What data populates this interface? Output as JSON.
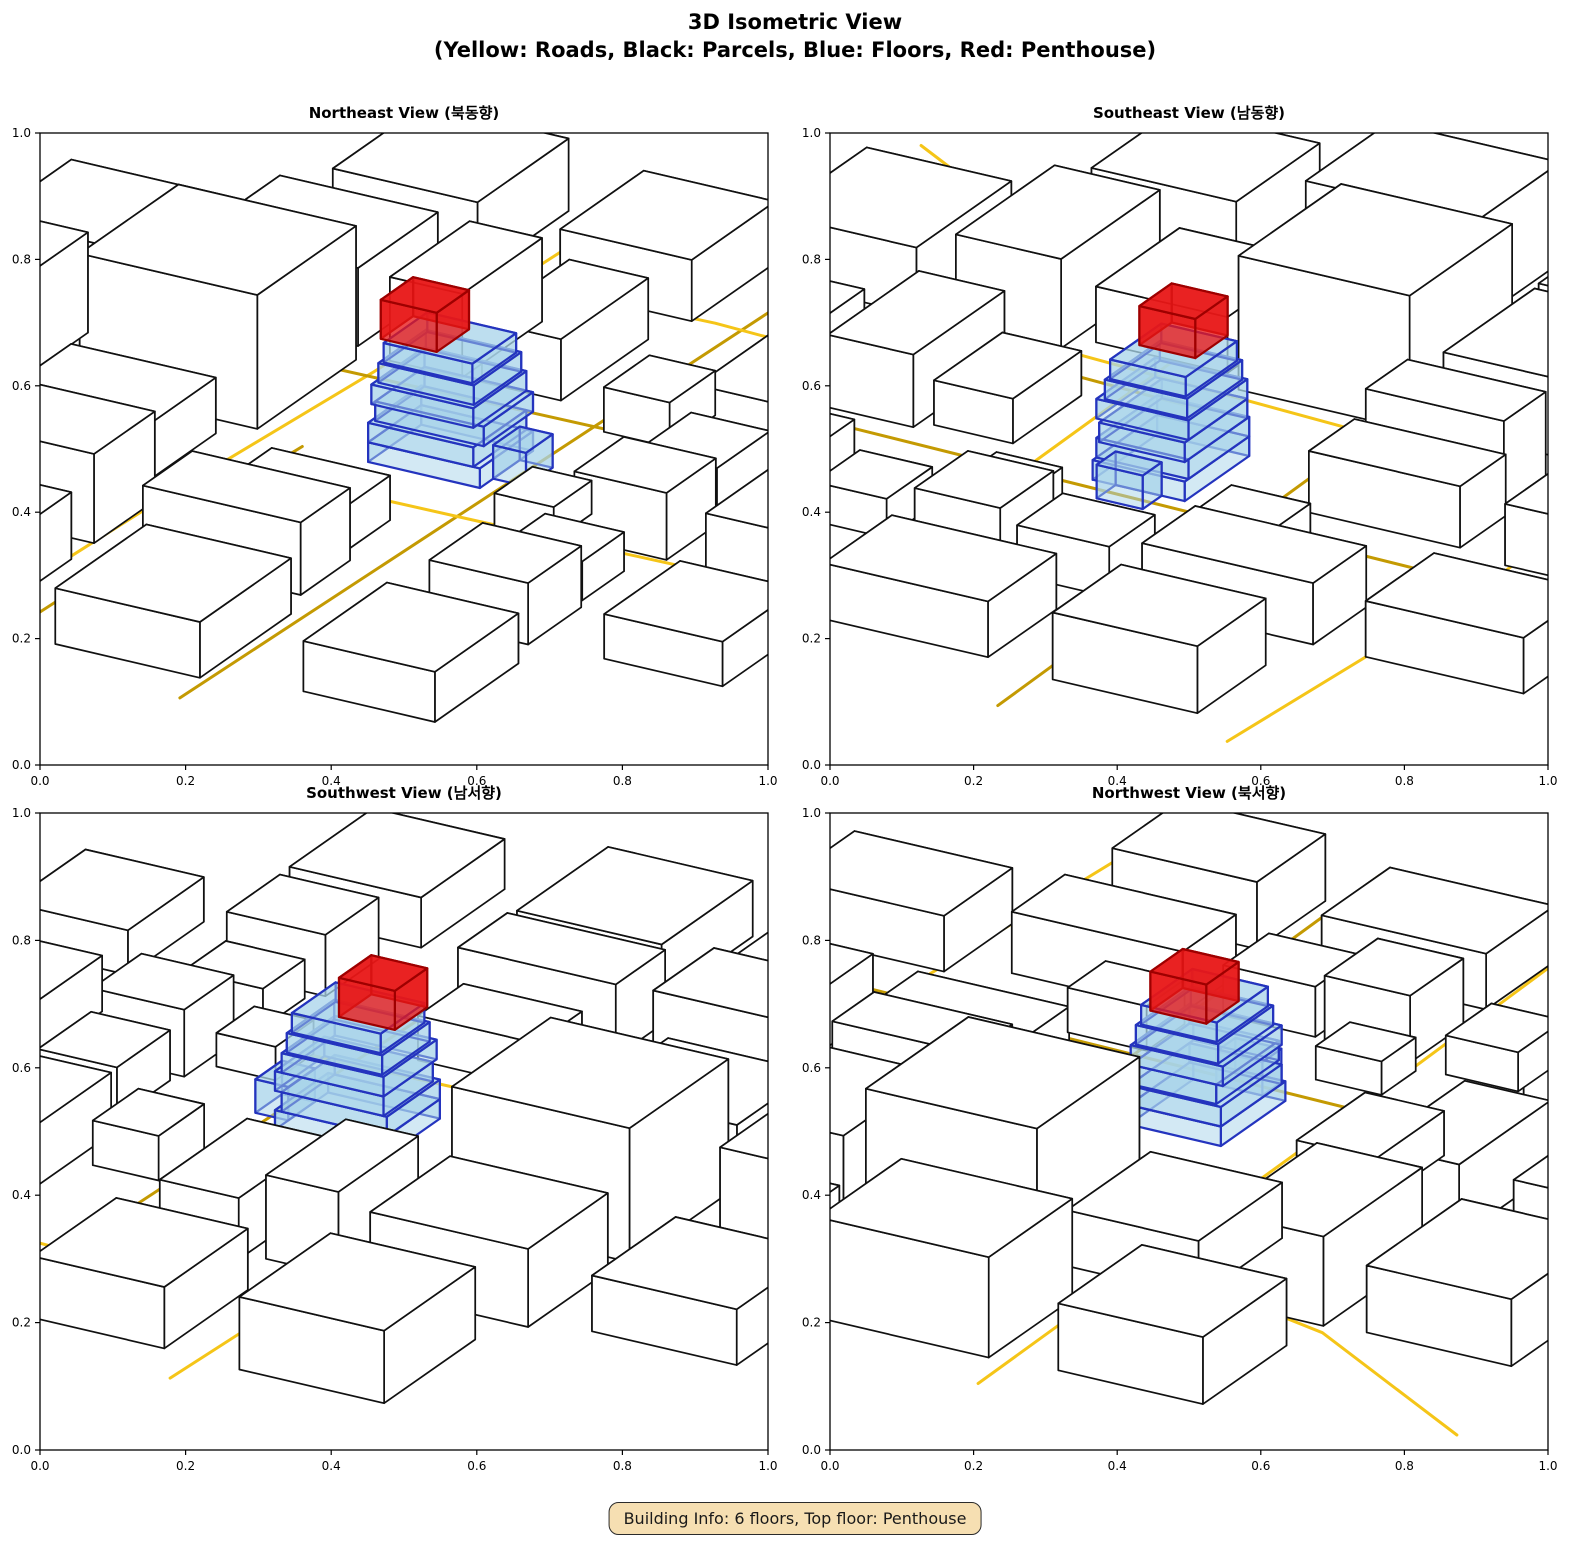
{
  "figure": {
    "title_line1": "3D Isometric View",
    "title_line2": "(Yellow: Roads, Black: Parcels, Blue: Floors, Red: Penthouse)"
  },
  "badge": {
    "text": "Building Info: 6 floors, Top floor: Penthouse"
  },
  "axes": {
    "tick_labels": [
      "0.0",
      "0.2",
      "0.4",
      "0.6",
      "0.8",
      "1.0"
    ],
    "tick_values": [
      0,
      0.2,
      0.4,
      0.6,
      0.8,
      1.0
    ],
    "x_range": [
      0,
      1
    ],
    "y_range": [
      0,
      1
    ]
  },
  "subplots": [
    {
      "id": "ne",
      "title": "Northeast View (북동향)",
      "azimuth_deg": 0
    },
    {
      "id": "se",
      "title": "Southeast View (남동향)",
      "azimuth_deg": -90
    },
    {
      "id": "sw",
      "title": "Southwest View (남서향)",
      "azimuth_deg": 180
    },
    {
      "id": "nw",
      "title": "Northwest View (북서향)",
      "azimuth_deg": 90
    }
  ],
  "colors": {
    "road_gold": "#F5C518",
    "road_dark": "#C49A02",
    "parcel_fill": "#FFFFFF",
    "parcel_edge": "#111111",
    "floor_fill": "#A8D4EA",
    "floor_edge": "#2434BE",
    "floor_opacity": 0.5,
    "penthouse_fill": "#E81717",
    "penthouse_edge": "#9E0000",
    "penthouse_opacity": 0.78,
    "axis": "#000000",
    "badge_bg": "#F6DFB2",
    "badge_border": "#2b2b2b"
  },
  "chart_data": {
    "type": "3d-city-isometric",
    "legend": {
      "roads": "Yellow",
      "parcels": "Black",
      "floors": "Blue",
      "penthouse": "Red"
    },
    "building": {
      "floors": 6,
      "top_floor": "Penthouse",
      "floor_boxes": [
        [
          0.44,
          0.35,
          0.14,
          0.17,
          0.0,
          0.035
        ],
        [
          0.44,
          0.36,
          0.14,
          0.16,
          0.035,
          0.035
        ],
        [
          0.45,
          0.35,
          0.13,
          0.165,
          0.07,
          0.035
        ],
        [
          0.44,
          0.36,
          0.14,
          0.155,
          0.105,
          0.035
        ],
        [
          0.45,
          0.365,
          0.125,
          0.145,
          0.14,
          0.035
        ],
        [
          0.455,
          0.37,
          0.115,
          0.135,
          0.175,
          0.035
        ]
      ],
      "annex_box": [
        0.475,
        0.3,
        0.07,
        0.05,
        0.0,
        0.06
      ],
      "penthouse_box": [
        0.465,
        0.43,
        0.085,
        0.085,
        0.21,
        0.07
      ]
    },
    "parcels": [
      [
        0.03,
        0.7,
        0.16,
        0.26,
        0.16
      ],
      [
        0.22,
        0.74,
        0.2,
        0.22,
        0.1
      ],
      [
        0.46,
        0.7,
        0.26,
        0.27,
        0.24
      ],
      [
        0.76,
        0.72,
        0.21,
        0.24,
        0.14
      ],
      [
        0.02,
        0.38,
        0.13,
        0.24,
        0.13
      ],
      [
        0.17,
        0.4,
        0.12,
        0.18,
        0.08
      ],
      [
        0.74,
        0.4,
        0.23,
        0.12,
        0.11
      ],
      [
        0.74,
        0.55,
        0.21,
        0.11,
        0.15
      ],
      [
        0.03,
        0.04,
        0.14,
        0.15,
        0.11
      ],
      [
        0.19,
        0.05,
        0.11,
        0.12,
        0.07
      ],
      [
        0.36,
        0.02,
        0.13,
        0.14,
        0.12
      ],
      [
        0.51,
        0.03,
        0.14,
        0.12,
        0.09
      ],
      [
        0.7,
        0.03,
        0.26,
        0.14,
        0.11
      ],
      [
        0.34,
        0.18,
        0.1,
        0.09,
        0.06
      ],
      [
        0.68,
        0.2,
        0.12,
        0.1,
        0.08
      ],
      [
        -0.25,
        0.7,
        0.22,
        0.25,
        0.12
      ],
      [
        -0.28,
        0.36,
        0.24,
        0.22,
        0.1
      ],
      [
        -0.25,
        0.02,
        0.22,
        0.2,
        0.09
      ],
      [
        1.04,
        0.7,
        0.24,
        0.22,
        0.13
      ],
      [
        1.05,
        0.38,
        0.22,
        0.2,
        0.11
      ],
      [
        1.04,
        0.03,
        0.24,
        0.18,
        0.1
      ],
      [
        0.04,
        1.04,
        0.22,
        0.22,
        0.12
      ],
      [
        0.36,
        1.05,
        0.26,
        0.22,
        0.18
      ],
      [
        0.72,
        1.04,
        0.22,
        0.22,
        0.1
      ],
      [
        0.36,
        -0.22,
        0.25,
        0.18,
        0.1
      ],
      [
        0.04,
        -0.25,
        0.2,
        0.18,
        0.08
      ],
      [
        0.72,
        -0.24,
        0.22,
        0.18,
        0.12
      ]
    ],
    "roads": [
      {
        "tone": "gold",
        "pts": [
          [
            -0.35,
            0.72
          ],
          [
            0.2,
            0.695
          ],
          [
            0.7,
            0.66
          ],
          [
            1.35,
            0.635
          ]
        ]
      },
      {
        "tone": "dark",
        "pts": [
          [
            -0.35,
            0.655
          ],
          [
            0.2,
            0.635
          ],
          [
            0.44,
            0.62
          ]
        ]
      },
      {
        "tone": "dark",
        "pts": [
          [
            -0.35,
            0.35
          ],
          [
            0.5,
            0.325
          ],
          [
            1.35,
            0.3
          ]
        ]
      },
      {
        "tone": "gold",
        "pts": [
          [
            0.36,
            -0.35
          ],
          [
            0.345,
            0.3
          ],
          [
            0.33,
            1.35
          ]
        ]
      },
      {
        "tone": "dark",
        "pts": [
          [
            0.7,
            -0.35
          ],
          [
            0.685,
            0.5
          ],
          [
            0.67,
            1.35
          ]
        ]
      },
      {
        "tone": "gold",
        "pts": [
          [
            -0.3,
            1.18
          ],
          [
            0.02,
            0.98
          ],
          [
            0.25,
            0.92
          ],
          [
            0.33,
            0.9
          ]
        ]
      },
      {
        "tone": "gold",
        "pts": [
          [
            1.02,
            -0.3
          ],
          [
            1.06,
            0.35
          ],
          [
            1.04,
            0.9
          ]
        ]
      }
    ],
    "scene_rotation_deg": 15
  }
}
